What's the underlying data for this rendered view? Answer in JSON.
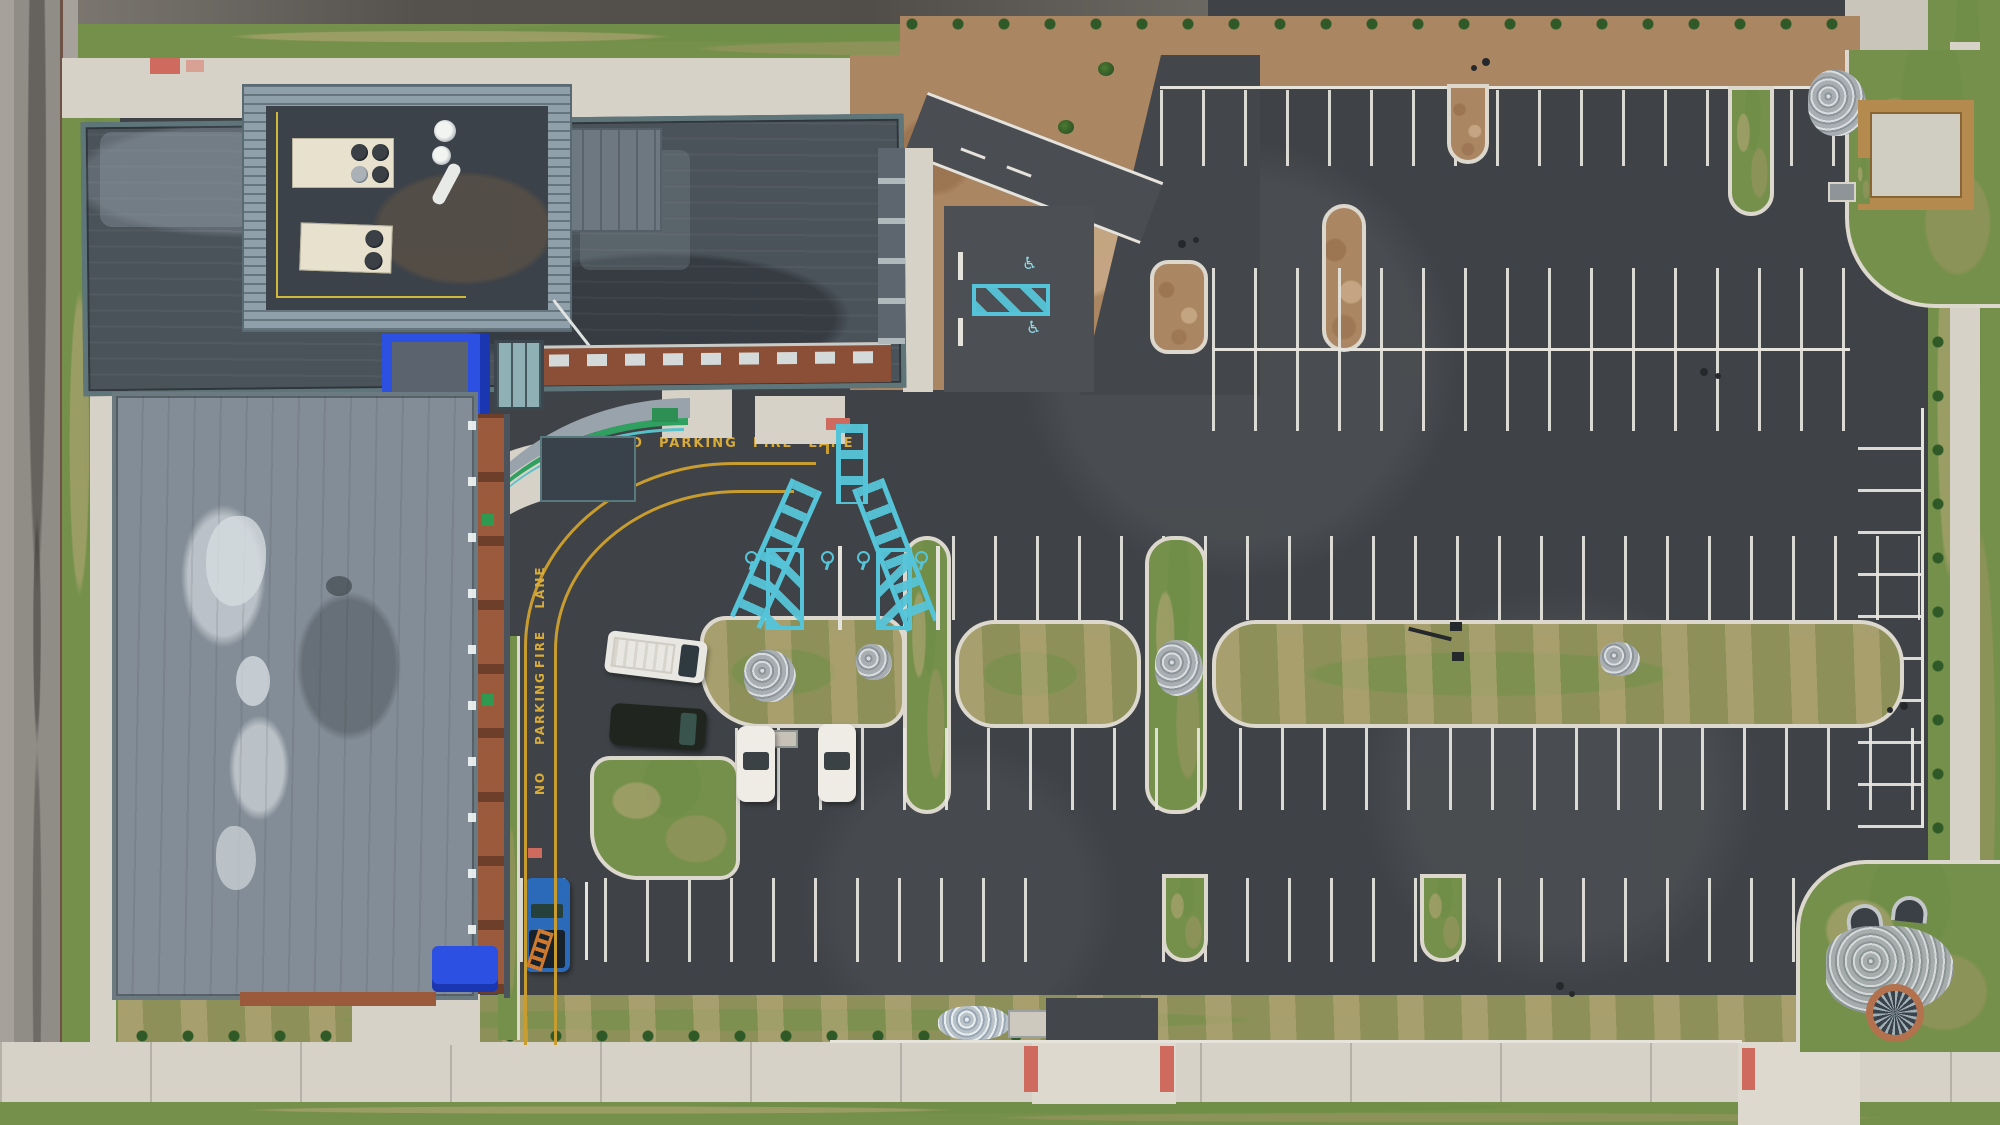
{
  "scene": {
    "description": "Aerial drone view of a modern brick-and-metal building (top left) with rooftop HVAC mechanical well, curved entry canopy, fire lane, and a large newly striped empty parking lot with landscaped medians",
    "colors": {
      "asphalt": "#43474b",
      "concrete_sidewalk": "#d6d2c8",
      "road_concrete": "#a6a29b",
      "grass": "#74904a",
      "mulch": "#ab8663",
      "roof_dark": "#4a525a",
      "roof_weathered": "#838d97",
      "metal_teal_parapet": "#5e767a",
      "brick": "#9c5a3d",
      "accent_blue": "#2b50e2",
      "marking_yellow": "#d8ab3a",
      "marking_teal": "#56c4d8",
      "stripe_white": "#e6e3dc",
      "curb_ramp_red": "#cf6a5f",
      "hvac_cream": "#e7e1cd",
      "wood_fence": "#b58a4e"
    }
  },
  "markings": {
    "fire_lane_horizontal": {
      "words": [
        "NO",
        "PARKING",
        "FIRE",
        "LANE"
      ]
    },
    "fire_lane_vertical": {
      "words": [
        "NO",
        "PARKING",
        "FIRE",
        "LANE"
      ]
    },
    "accessible_symbol": "♿"
  },
  "vehicles": [
    {
      "name": "white-utility-van",
      "color": "#e9e7e2"
    },
    {
      "name": "dark-suv",
      "color": "#20261f"
    },
    {
      "name": "white-sedan-1",
      "color": "#efece6"
    },
    {
      "name": "white-sedan-2",
      "color": "#efece6"
    },
    {
      "name": "blue-pickup-with-ladder",
      "color": "#2a6ab8"
    }
  ]
}
